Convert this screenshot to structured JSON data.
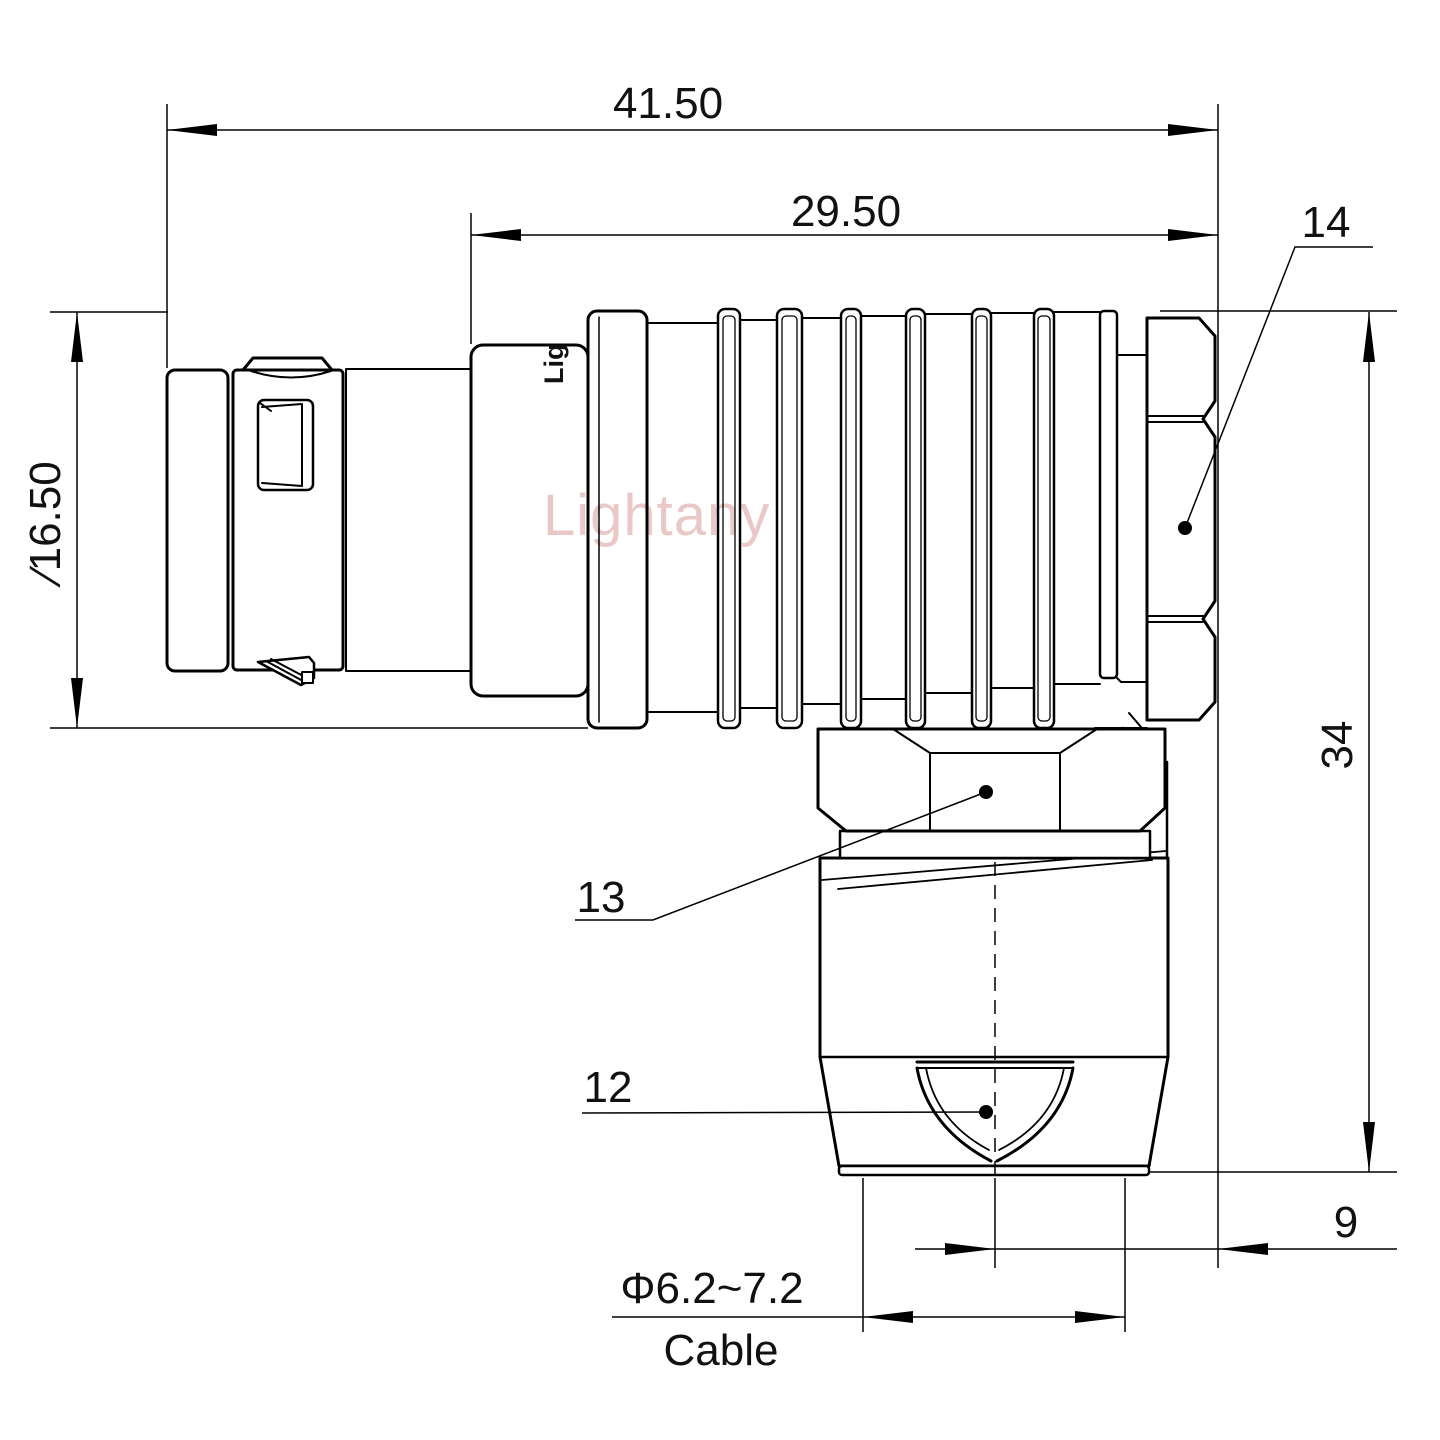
{
  "drawing": {
    "type": "right-angle connector dimension drawing",
    "background": "#ffffff",
    "line_color": "#000000",
    "watermark_color": "#d89a9a"
  },
  "dimensions": {
    "overall_length": "41.50",
    "section_length": "29.50",
    "front_diameter": "∕16.50",
    "height": "34",
    "elbow_offset": "9",
    "cable_diameter": "Φ6.2~7.2",
    "cable_word": "Cable"
  },
  "callouts": {
    "c14": "14",
    "c13": "13",
    "c12": "12"
  },
  "watermark": "Lightany",
  "marking": "Lig"
}
